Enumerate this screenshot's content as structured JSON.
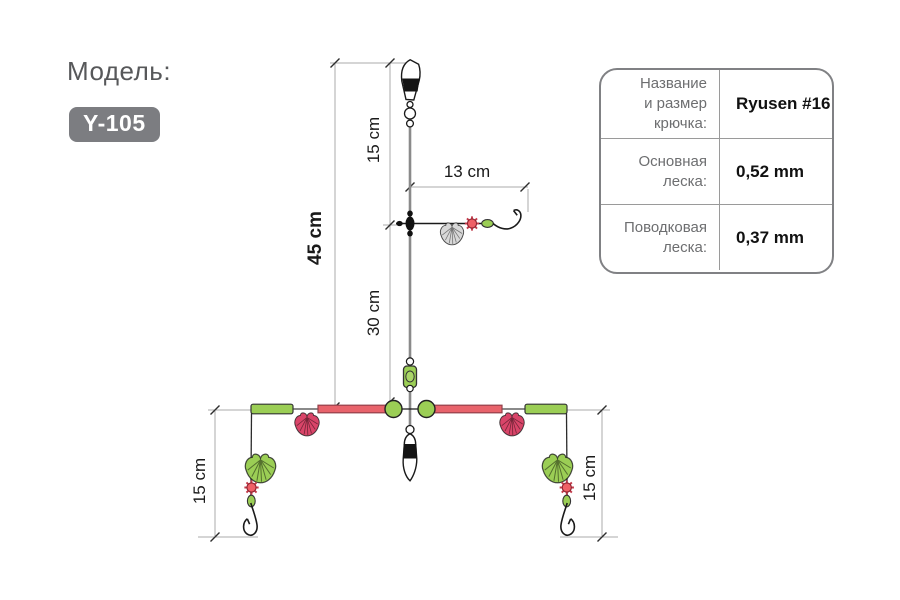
{
  "header": {
    "label": "Модель:",
    "model": "Y-105"
  },
  "spec_table": {
    "rows": [
      {
        "label": "Название\nи размер\nкрючка:",
        "value": "Ryusen #16"
      },
      {
        "label": "Основная\nлеска:",
        "value": "0,52 mm"
      },
      {
        "label": "Поводковая\nлеска:",
        "value": "0,37 mm"
      }
    ]
  },
  "dimensions": {
    "top_segment": "15 cm",
    "total": "45 cm",
    "middle_segment": "30 cm",
    "branch_length": "13 cm",
    "left_dropper": "15 cm",
    "right_dropper": "15 cm"
  },
  "colors": {
    "badge_gray": "#7c7d81",
    "bead_green": "#9bce55",
    "bar_red": "#e8636b",
    "shell_red": "#d94569",
    "shell_gray": "#d8d8d8",
    "flower_red": "#ef6066",
    "main_line_gray": "#8a8a8a"
  }
}
